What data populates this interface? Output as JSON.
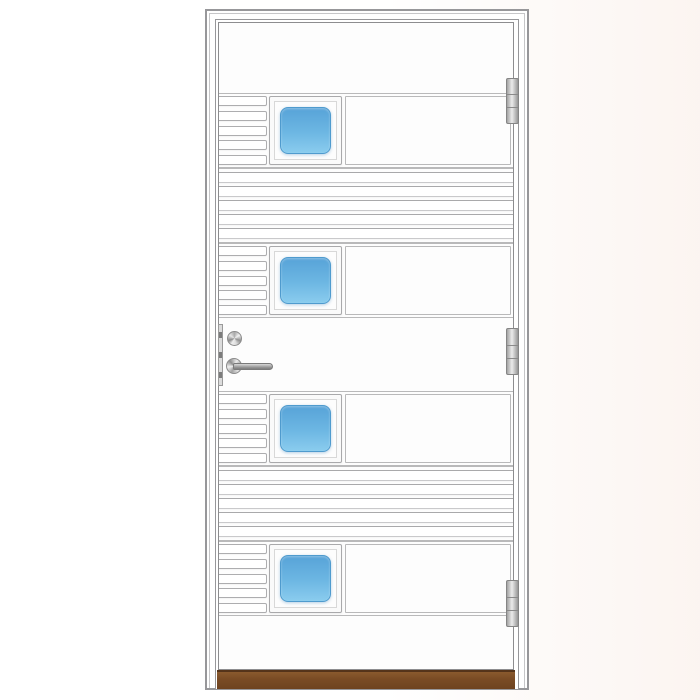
{
  "scene": {
    "type": "product-photo",
    "subject": "White exterior front door with four square blue-glass windows, horizontal groove panels, lever handle with lock cylinder, three hinges and a wooden threshold, shown in a white door frame"
  },
  "colors": {
    "background": "#ffffff",
    "background_tint": "#faf1ec",
    "door_white": "#fdfdfd",
    "frame_outline": "#97979a",
    "frame_step": "#c6c6c8",
    "leaf_outline": "#8d8d8f",
    "panel_line": "#b9b9ba",
    "slat_line": "#adadaf",
    "groove_line": "#a9a9ab",
    "glass_top": "#57a3d8",
    "glass_mid": "#6db7e3",
    "glass_bottom": "#8accee",
    "glass_border": "#4f9bce",
    "metal_light": "#ebebeb",
    "metal_dark": "#8a8a8a",
    "threshold_top": "#8a5a2e",
    "threshold_bottom": "#6e431f",
    "threshold_edge": "#55341a"
  },
  "door": {
    "window_count": 4,
    "windows_shape": "square, rounded-corner blue glass",
    "slats_per_window_row": 5,
    "groove_band_count": 2,
    "grooves_per_band": 5,
    "hinge_count": 3,
    "hardware": [
      "lock-cylinder",
      "lever-handle",
      "lock-faceplate"
    ],
    "threshold_material": "wood",
    "handle_side": "left",
    "hinge_side": "right"
  }
}
